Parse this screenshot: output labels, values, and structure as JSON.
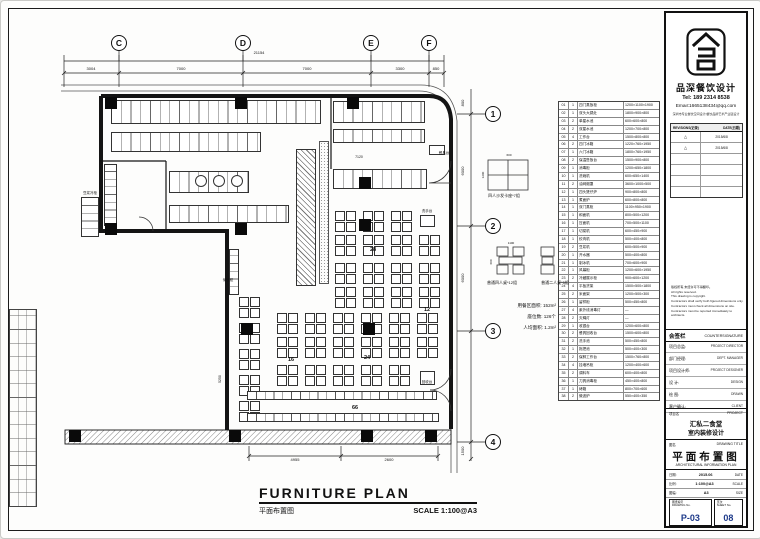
{
  "company": {
    "name": "品深餐饮设计",
    "tel": "Tel: 189 2314 8538",
    "email": "Email:1665138434@qq.com",
    "tagline": "深圳市专业餐饮空间设计|餐饮品牌艺术产业链设计"
  },
  "revisions": {
    "head_left": "REVISIONS(记录)",
    "head_right": "DATE(日期)",
    "rows": [
      {
        "m": "△",
        "d": "2015/6/8"
      },
      {
        "m": "△",
        "d": "2015/6/8"
      },
      {
        "m": "",
        "d": ""
      },
      {
        "m": "",
        "d": ""
      },
      {
        "m": "",
        "d": ""
      },
      {
        "m": "",
        "d": ""
      }
    ]
  },
  "notes": [
    "版权所有,未经许可不得翻印。",
    "All rights reserved.",
    "This drawing is copyright.",
    "Contractors shall verify both figured dimensions only.",
    "Contractors must check all dimensions on site.",
    "Contractors must be reported immediately to architects."
  ],
  "countersign": {
    "cn": "会签栏",
    "en": "COUNTERSIGNATURE",
    "rows": [
      {
        "cn": "项目总监:",
        "en": "PROJECT DIRECTOR"
      },
      {
        "cn": "部门经理:",
        "en": "DEPT. MANAGER"
      },
      {
        "cn": "项目设计师:",
        "en": "PROJECT DESIGNER"
      },
      {
        "cn": "设  计:",
        "en": "DESIGN"
      },
      {
        "cn": "绘  图:",
        "en": "DRAWN"
      },
      {
        "cn": "客户确认:",
        "en": "CLIENT"
      }
    ]
  },
  "project": {
    "label_cn": "项目名",
    "label_en": "PROJECT",
    "name1": "汇私二食堂",
    "name2": "室内装修设计"
  },
  "drawing": {
    "label_cn": "图名",
    "label_en": "DRAWING TITLE",
    "title": "平面布置图",
    "subtitle": "ARCHITECTURAL INFORMATION PLAN"
  },
  "meta_rows": [
    {
      "cn": "日期:",
      "val": "2015.06",
      "en": "DATE"
    },
    {
      "cn": "比例:",
      "val": "1:100@A3",
      "en": "SCALE"
    },
    {
      "cn": "图幅:",
      "val": "A3",
      "en": "SIZE"
    }
  ],
  "numbers": {
    "sheet_cn": "图纸编号",
    "sheet_en": "DRAWING No.",
    "sheet_no": "P-03",
    "page_cn": "页次",
    "page_en": "SHEET No.",
    "page_no": "08"
  },
  "footer": {
    "title": "FURNITURE PLAN",
    "subtitle_cn": "平面布置图",
    "scale": "SCALE 1:100@A3"
  },
  "side": {
    "booth_caption": "四人沙发卡座*7组",
    "four_caption": "普通四人桌*12组",
    "two_caption": "普通二人桌*5组",
    "stats": [
      "用餐区面积: 152m²",
      "座位数: 126个",
      "人均面积: 1.2m²"
    ]
  },
  "schedule": {
    "rows": [
      {
        "n": "01",
        "q": "1",
        "t": "四门蒸饭柜",
        "s": "1200×1100×1900"
      },
      {
        "n": "02",
        "q": "1",
        "t": "双头大锅灶",
        "s": "1800×900×800"
      },
      {
        "n": "03",
        "q": "2",
        "t": "单星水池",
        "s": "600×600×800"
      },
      {
        "n": "04",
        "q": "2",
        "t": "双星水池",
        "s": "1200×700×800"
      },
      {
        "n": "05",
        "q": "4",
        "t": "工作台",
        "s": "1500×800×800"
      },
      {
        "n": "06",
        "q": "2",
        "t": "四门冰箱",
        "s": "1220×760×1950"
      },
      {
        "n": "07",
        "q": "1",
        "t": "六门冰箱",
        "s": "1800×760×1950"
      },
      {
        "n": "08",
        "q": "2",
        "t": "保温售饭台",
        "s": "1500×900×800"
      },
      {
        "n": "09",
        "q": "1",
        "t": "消毒柜",
        "s": "1200×650×1800"
      },
      {
        "n": "10",
        "q": "1",
        "t": "洗碗机",
        "s": "600×650×1400"
      },
      {
        "n": "11",
        "q": "2",
        "t": "油网烟罩",
        "s": "3600×1000×500"
      },
      {
        "n": "12",
        "q": "1",
        "t": "四头煲仔炉",
        "s": "900×800×800"
      },
      {
        "n": "13",
        "q": "1",
        "t": "煮面炉",
        "s": "600×800×800"
      },
      {
        "n": "14",
        "q": "1",
        "t": "双门蒸柜",
        "s": "1100×950×1900"
      },
      {
        "n": "15",
        "q": "1",
        "t": "和面机",
        "s": "800×500×1200"
      },
      {
        "n": "16",
        "q": "1",
        "t": "压面机",
        "s": "700×500×1100"
      },
      {
        "n": "17",
        "q": "1",
        "t": "切菜机",
        "s": "600×450×900"
      },
      {
        "n": "18",
        "q": "1",
        "t": "绞肉机",
        "s": "500×400×800"
      },
      {
        "n": "19",
        "q": "2",
        "t": "豆浆机",
        "s": "600×500×900"
      },
      {
        "n": "20",
        "q": "1",
        "t": "开水器",
        "s": "500×400×800"
      },
      {
        "n": "21",
        "q": "1",
        "t": "制冰机",
        "s": "700×600×900"
      },
      {
        "n": "22",
        "q": "1",
        "t": "风幕柜",
        "s": "1200×600×1950"
      },
      {
        "n": "23",
        "q": "2",
        "t": "冷藏展示柜",
        "s": "900×600×1200"
      },
      {
        "n": "24",
        "q": "4",
        "t": "平板货架",
        "s": "1500×500×1800"
      },
      {
        "n": "25",
        "q": "2",
        "t": "米面架",
        "s": "1200×500×300"
      },
      {
        "n": "26",
        "q": "1",
        "t": "留样柜",
        "s": "500×450×800"
      },
      {
        "n": "27",
        "q": "4",
        "t": "紫外线消毒灯",
        "s": "—"
      },
      {
        "n": "28",
        "q": "2",
        "t": "灭蝇灯",
        "s": "—"
      },
      {
        "n": "29",
        "q": "1",
        "t": "收银台",
        "s": "1200×600×800"
      },
      {
        "n": "30",
        "q": "2",
        "t": "餐具回收台",
        "s": "1500×600×800"
      },
      {
        "n": "31",
        "q": "2",
        "t": "洗手池",
        "s": "500×450×800"
      },
      {
        "n": "32",
        "q": "1",
        "t": "拖把池",
        "s": "500×400×300"
      },
      {
        "n": "33",
        "q": "2",
        "t": "保鲜工作台",
        "s": "1500×760×800"
      },
      {
        "n": "34",
        "q": "4",
        "t": "挂墙吊柜",
        "s": "1200×400×600"
      },
      {
        "n": "35",
        "q": "2",
        "t": "调料车",
        "s": "600×400×800"
      },
      {
        "n": "36",
        "q": "1",
        "t": "刀具消毒柜",
        "s": "450×400×800"
      },
      {
        "n": "37",
        "q": "1",
        "t": "烤箱",
        "s": "800×700×600"
      },
      {
        "n": "38",
        "q": "2",
        "t": "微波炉",
        "s": "550×400×350"
      }
    ]
  },
  "plan": {
    "labels": [
      {
        "t": "C",
        "x": 118,
        "y": 45,
        "s": 8.5,
        "b": 1
      },
      {
        "t": "D",
        "x": 242,
        "y": 45,
        "s": 8.5,
        "b": 1
      },
      {
        "t": "E",
        "x": 370,
        "y": 45,
        "s": 8.5,
        "b": 1
      },
      {
        "t": "F",
        "x": 428,
        "y": 45,
        "s": 8.5,
        "b": 1
      },
      {
        "t": "1",
        "x": 492,
        "y": 116,
        "s": 8.5,
        "b": 1
      },
      {
        "t": "2",
        "x": 492,
        "y": 228,
        "s": 8.5,
        "b": 1
      },
      {
        "t": "3",
        "x": 492,
        "y": 333,
        "s": 8.5,
        "b": 1
      },
      {
        "t": "4",
        "x": 492,
        "y": 444,
        "s": 8.5,
        "b": 1
      },
      {
        "t": "21154",
        "x": 258,
        "y": 53,
        "s": 4
      },
      {
        "t": "3004",
        "x": 90,
        "y": 69,
        "s": 4
      },
      {
        "t": "7000",
        "x": 180,
        "y": 69,
        "s": 4
      },
      {
        "t": "7000",
        "x": 306,
        "y": 69,
        "s": 4
      },
      {
        "t": "3300",
        "x": 399,
        "y": 69,
        "s": 4
      },
      {
        "t": "850",
        "x": 435,
        "y": 69,
        "s": 4
      },
      {
        "t": "800",
        "x": 463,
        "y": 102,
        "s": 4,
        "r": -90
      },
      {
        "t": "6000",
        "x": 463,
        "y": 170,
        "s": 4,
        "r": -90
      },
      {
        "t": "6000",
        "x": 463,
        "y": 277,
        "s": 4,
        "r": -90
      },
      {
        "t": "1500",
        "x": 463,
        "y": 450,
        "s": 4,
        "r": -90
      },
      {
        "t": "4955",
        "x": 294,
        "y": 460,
        "s": 4
      },
      {
        "t": "2600",
        "x": 388,
        "y": 460,
        "s": 4
      },
      {
        "t": "7120",
        "x": 358,
        "y": 157,
        "s": 3.5
      },
      {
        "t": "5250",
        "x": 220,
        "y": 378,
        "s": 3.5,
        "r": -90
      },
      {
        "t": "餐具台",
        "x": 443,
        "y": 153,
        "s": 3.5
      },
      {
        "t": "洗手台",
        "x": 426,
        "y": 211,
        "s": 3.5
      },
      {
        "t": "回收台",
        "x": 426,
        "y": 382,
        "s": 3.5
      },
      {
        "t": "储餐柜",
        "x": 227,
        "y": 280,
        "s": 3.5
      },
      {
        "t": "豆浆冷柜",
        "x": 89,
        "y": 193,
        "s": 3.5
      },
      {
        "t": "28",
        "x": 372,
        "y": 250,
        "s": 5.5,
        "b": 1
      },
      {
        "t": "12",
        "x": 426,
        "y": 310,
        "s": 5.5,
        "b": 1
      },
      {
        "t": "24",
        "x": 366,
        "y": 358,
        "s": 5.5,
        "b": 1
      },
      {
        "t": "16",
        "x": 290,
        "y": 360,
        "s": 5.5,
        "b": 1
      },
      {
        "t": "66",
        "x": 354,
        "y": 408,
        "s": 5.5,
        "b": 1
      },
      {
        "t": "600",
        "x": 508,
        "y": 155,
        "s": 3
      },
      {
        "t": "1200",
        "x": 483,
        "y": 174,
        "s": 3,
        "r": -90
      },
      {
        "t": "1100",
        "x": 510,
        "y": 243,
        "s": 3
      },
      {
        "t": "600",
        "x": 491,
        "y": 261,
        "s": 3,
        "r": -90
      }
    ],
    "tables": [
      {
        "k": "four",
        "x": 334,
        "y": 210
      },
      {
        "k": "four",
        "x": 362,
        "y": 210
      },
      {
        "k": "four",
        "x": 390,
        "y": 210
      },
      {
        "k": "four",
        "x": 334,
        "y": 234
      },
      {
        "k": "four",
        "x": 362,
        "y": 234
      },
      {
        "k": "four",
        "x": 390,
        "y": 234
      },
      {
        "k": "four",
        "x": 418,
        "y": 234
      },
      {
        "k": "four",
        "x": 334,
        "y": 262
      },
      {
        "k": "four",
        "x": 362,
        "y": 262
      },
      {
        "k": "four",
        "x": 390,
        "y": 262
      },
      {
        "k": "four",
        "x": 418,
        "y": 262
      },
      {
        "k": "four",
        "x": 334,
        "y": 286
      },
      {
        "k": "four",
        "x": 362,
        "y": 286
      },
      {
        "k": "four",
        "x": 390,
        "y": 286
      },
      {
        "k": "four",
        "x": 418,
        "y": 286
      },
      {
        "k": "four",
        "x": 276,
        "y": 312
      },
      {
        "k": "four",
        "x": 304,
        "y": 312
      },
      {
        "k": "four",
        "x": 332,
        "y": 312
      },
      {
        "k": "four",
        "x": 360,
        "y": 312
      },
      {
        "k": "four",
        "x": 388,
        "y": 312
      },
      {
        "k": "four",
        "x": 416,
        "y": 312
      },
      {
        "k": "four",
        "x": 276,
        "y": 336
      },
      {
        "k": "four",
        "x": 304,
        "y": 336
      },
      {
        "k": "four",
        "x": 332,
        "y": 336
      },
      {
        "k": "four",
        "x": 360,
        "y": 336
      },
      {
        "k": "four",
        "x": 388,
        "y": 336
      },
      {
        "k": "four",
        "x": 416,
        "y": 336
      },
      {
        "k": "four",
        "x": 276,
        "y": 364
      },
      {
        "k": "four",
        "x": 304,
        "y": 364
      },
      {
        "k": "four",
        "x": 332,
        "y": 364
      },
      {
        "k": "four",
        "x": 360,
        "y": 364
      },
      {
        "k": "four",
        "x": 388,
        "y": 364
      },
      {
        "k": "four",
        "x": 238,
        "y": 296
      },
      {
        "k": "four",
        "x": 238,
        "y": 322
      },
      {
        "k": "four",
        "x": 238,
        "y": 348
      },
      {
        "k": "four",
        "x": 238,
        "y": 374
      },
      {
        "k": "four",
        "x": 238,
        "y": 400
      },
      {
        "k": "row",
        "x": 246,
        "y": 390,
        "w": 190,
        "h": 9
      },
      {
        "k": "row",
        "x": 246,
        "y": 412,
        "w": 192,
        "h": 9
      },
      {
        "k": "eq",
        "x": 332,
        "y": 168,
        "w": 94,
        "h": 20
      },
      {
        "k": "eq",
        "x": 110,
        "y": 99,
        "w": 210,
        "h": 24
      },
      {
        "k": "eq",
        "x": 332,
        "y": 100,
        "w": 92,
        "h": 22
      },
      {
        "k": "eq",
        "x": 332,
        "y": 128,
        "w": 92,
        "h": 14
      },
      {
        "k": "eq",
        "x": 110,
        "y": 131,
        "w": 150,
        "h": 20
      },
      {
        "k": "eq",
        "x": 168,
        "y": 170,
        "w": 80,
        "h": 22
      },
      {
        "k": "eq",
        "x": 168,
        "y": 204,
        "w": 120,
        "h": 18
      },
      {
        "k": "eqv",
        "x": 103,
        "y": 163,
        "w": 13,
        "h": 62
      },
      {
        "k": "eqv",
        "x": 80,
        "y": 196,
        "w": 18,
        "h": 40
      },
      {
        "k": "eqv",
        "x": 228,
        "y": 248,
        "w": 10,
        "h": 46
      },
      {
        "k": "hatch",
        "x": 295,
        "y": 148,
        "w": 20,
        "h": 137
      },
      {
        "k": "stip",
        "x": 318,
        "y": 140,
        "w": 10,
        "h": 143
      },
      {
        "k": "box",
        "x": 419,
        "y": 214,
        "w": 15,
        "h": 12
      },
      {
        "k": "box",
        "x": 419,
        "y": 370,
        "w": 15,
        "h": 14
      },
      {
        "k": "box",
        "x": 428,
        "y": 144,
        "w": 16,
        "h": 10
      },
      {
        "k": "circ",
        "x": 194,
        "y": 174
      },
      {
        "k": "circ",
        "x": 212,
        "y": 174
      },
      {
        "k": "circ",
        "x": 230,
        "y": 174
      },
      {
        "k": "blk",
        "x": 104,
        "y": 96
      },
      {
        "k": "blk",
        "x": 234,
        "y": 96
      },
      {
        "k": "blk",
        "x": 346,
        "y": 96
      },
      {
        "k": "blk",
        "x": 104,
        "y": 222
      },
      {
        "k": "blk",
        "x": 234,
        "y": 222
      },
      {
        "k": "blk",
        "x": 358,
        "y": 176
      },
      {
        "k": "blk",
        "x": 358,
        "y": 218
      },
      {
        "k": "blk",
        "x": 362,
        "y": 322
      },
      {
        "k": "blk",
        "x": 240,
        "y": 322
      },
      {
        "k": "blk",
        "x": 228,
        "y": 429
      },
      {
        "k": "blk",
        "x": 360,
        "y": 429
      },
      {
        "k": "blk",
        "x": 424,
        "y": 429
      },
      {
        "k": "blk",
        "x": 68,
        "y": 429
      }
    ]
  }
}
